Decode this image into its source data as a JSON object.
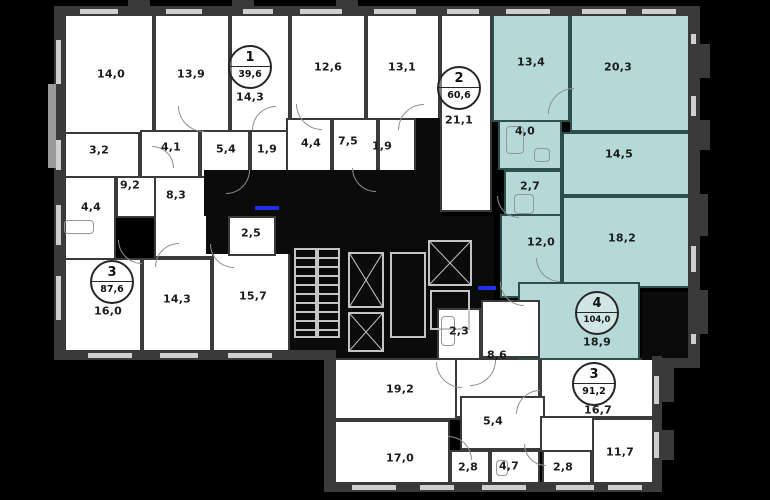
{
  "title": "apartment-floor-plan",
  "colors": {
    "background": "#000000",
    "wall": "#3a3a3a",
    "room_fill": "#ffffff",
    "selected_apartment_fill": "#b5d9d8",
    "selected_apartment_wall": "#2e4d4d",
    "window": "#cfcfcf",
    "core_lines": "#c4c4c4",
    "entry_marker": "#2330e8",
    "label_text": "#1b1b1b"
  },
  "apartments": [
    {
      "number": "1",
      "total_area": "39,6",
      "highlighted": false
    },
    {
      "number": "2",
      "total_area": "60,6",
      "highlighted": false
    },
    {
      "number": "3",
      "total_area": "87,6",
      "highlighted": false
    },
    {
      "number": "4",
      "total_area": "104,0",
      "highlighted": true
    },
    {
      "number": "3",
      "total_area": "91,2",
      "highlighted": false
    }
  ],
  "plan": {
    "width": 770,
    "height": 500,
    "rooms": [
      {
        "n": "room-14-0",
        "t": "room",
        "r": [
          62,
          14,
          92,
          120
        ]
      },
      {
        "n": "room-13-9",
        "t": "room",
        "r": [
          154,
          14,
          76,
          120
        ]
      },
      {
        "n": "apt1-room-14-3",
        "t": "room",
        "r": [
          230,
          14,
          60,
          120
        ]
      },
      {
        "n": "room-12-6",
        "t": "room",
        "r": [
          290,
          14,
          76,
          120
        ]
      },
      {
        "n": "room-13-1",
        "t": "room",
        "r": [
          366,
          14,
          74,
          120
        ]
      },
      {
        "n": "apt2-room-21-1",
        "t": "room",
        "r": [
          440,
          14,
          52,
          198
        ]
      },
      {
        "n": "room-3-2",
        "t": "room",
        "r": [
          62,
          132,
          78,
          46
        ]
      },
      {
        "n": "room-4-1",
        "t": "room",
        "r": [
          140,
          130,
          60,
          48
        ]
      },
      {
        "n": "room-5-4",
        "t": "room",
        "r": [
          200,
          130,
          50,
          48
        ]
      },
      {
        "n": "room-1-9",
        "t": "room",
        "r": [
          250,
          130,
          38,
          48
        ]
      },
      {
        "n": "room-4-4-left",
        "t": "room",
        "r": [
          62,
          176,
          54,
          84
        ]
      },
      {
        "n": "hall-9-2",
        "t": "room",
        "r": [
          116,
          176,
          88,
          42
        ]
      },
      {
        "n": "hall-8-3",
        "t": "room",
        "r": [
          154,
          176,
          62,
          82
        ]
      },
      {
        "n": "room-16-0",
        "t": "room",
        "r": [
          62,
          258,
          80,
          96
        ]
      },
      {
        "n": "room-14-3-b",
        "t": "room",
        "r": [
          142,
          258,
          70,
          96
        ]
      },
      {
        "n": "room-15-7",
        "t": "room",
        "r": [
          212,
          250,
          78,
          104
        ]
      },
      {
        "n": "room-4-4-top",
        "t": "room",
        "r": [
          286,
          118,
          46,
          54
        ]
      },
      {
        "n": "room-7-5",
        "t": "room",
        "r": [
          332,
          118,
          46,
          54
        ]
      },
      {
        "n": "room-1-9-top",
        "t": "room",
        "r": [
          378,
          118,
          38,
          54
        ]
      },
      {
        "n": "room-19-2",
        "t": "room",
        "r": [
          332,
          358,
          128,
          62
        ]
      },
      {
        "n": "hall-8-6-lower",
        "t": "room",
        "r": [
          455,
          358,
          85,
          60
        ]
      },
      {
        "n": "apt3b-room-16-7",
        "t": "room",
        "r": [
          540,
          358,
          114,
          60
        ]
      },
      {
        "n": "hall-5-4-b",
        "t": "room",
        "r": [
          460,
          396,
          85,
          54
        ]
      },
      {
        "n": "hall-sliver",
        "t": "room",
        "r": [
          540,
          416,
          54,
          36
        ]
      },
      {
        "n": "room-17-0",
        "t": "room",
        "r": [
          332,
          420,
          118,
          64
        ]
      },
      {
        "n": "room-2-8-a",
        "t": "room",
        "r": [
          450,
          450,
          40,
          34
        ]
      },
      {
        "n": "room-4-7",
        "t": "room",
        "r": [
          490,
          450,
          50,
          34
        ]
      },
      {
        "n": "room-2-8-b",
        "t": "room",
        "r": [
          542,
          450,
          50,
          34
        ]
      },
      {
        "n": "room-11-7",
        "t": "room",
        "r": [
          592,
          418,
          62,
          66
        ]
      },
      {
        "n": "apt4-room-13-4",
        "t": "teal",
        "r": [
          492,
          14,
          78,
          108
        ]
      },
      {
        "n": "apt4-room-20-3",
        "t": "teal",
        "r": [
          570,
          14,
          120,
          118
        ]
      },
      {
        "n": "apt4-bath-4-0",
        "t": "teal",
        "r": [
          498,
          120,
          64,
          50
        ]
      },
      {
        "n": "apt4-room-14-5",
        "t": "teal",
        "r": [
          562,
          132,
          128,
          64
        ]
      },
      {
        "n": "apt4-bath-2-7",
        "t": "teal",
        "r": [
          504,
          170,
          58,
          46
        ]
      },
      {
        "n": "apt4-hall-12-0",
        "t": "teal",
        "r": [
          500,
          214,
          62,
          84
        ]
      },
      {
        "n": "apt4-room-18-2",
        "t": "teal",
        "r": [
          562,
          196,
          128,
          92
        ]
      },
      {
        "n": "apt4-room-18-9",
        "t": "teal",
        "r": [
          518,
          282,
          122,
          78
        ]
      }
    ],
    "dark": [
      {
        "n": "public-corridor",
        "r": [
          204,
          170,
          236,
          46
        ]
      },
      {
        "n": "core-block",
        "r": [
          290,
          216,
          204,
          142
        ]
      },
      {
        "n": "shaft-strip",
        "r": [
          416,
          118,
          24,
          98
        ]
      },
      {
        "n": "void-right",
        "r": [
          642,
          292,
          48,
          68
        ]
      },
      {
        "n": "corridor-niche-a",
        "r": [
          206,
          216,
          26,
          38
        ]
      },
      {
        "n": "corridor-niche-b",
        "r": [
          276,
          216,
          14,
          38
        ]
      }
    ],
    "punch": [
      {
        "n": "room-2-5",
        "r": [
          228,
          216,
          48,
          40
        ]
      },
      {
        "n": "room-2-3",
        "r": [
          437,
          308,
          44,
          52
        ]
      },
      {
        "n": "hall-8-6-upper",
        "r": [
          481,
          300,
          59,
          58
        ]
      }
    ],
    "stairs": [
      {
        "n": "stair-flight-a",
        "r": [
          294,
          248,
          23,
          90
        ]
      },
      {
        "n": "stair-flight-b",
        "r": [
          317,
          248,
          23,
          90
        ]
      }
    ],
    "elevators": [
      {
        "n": "elevator-a",
        "r": [
          348,
          252,
          36,
          56
        ]
      },
      {
        "n": "elevator-b",
        "r": [
          348,
          312,
          36,
          40
        ]
      },
      {
        "n": "elevator-c",
        "r": [
          428,
          240,
          44,
          46
        ]
      }
    ],
    "coreboxes": [
      {
        "n": "shaft-box",
        "r": [
          390,
          252,
          36,
          86
        ]
      },
      {
        "n": "lobby-box",
        "r": [
          430,
          290,
          40,
          40
        ]
      }
    ],
    "walls": [
      {
        "r": [
          54,
          6,
          646,
          10
        ]
      },
      {
        "r": [
          54,
          6,
          12,
          354
        ]
      },
      {
        "r": [
          54,
          350,
          280,
          10
        ]
      },
      {
        "r": [
          324,
          350,
          12,
          142
        ]
      },
      {
        "r": [
          324,
          482,
          338,
          10
        ]
      },
      {
        "r": [
          652,
          356,
          10,
          136
        ]
      },
      {
        "r": [
          688,
          6,
          12,
          362
        ]
      },
      {
        "r": [
          652,
          358,
          48,
          10
        ]
      }
    ],
    "windows": [
      {
        "r": [
          80,
          9,
          38,
          5
        ]
      },
      {
        "r": [
          166,
          9,
          36,
          5
        ]
      },
      {
        "r": [
          243,
          9,
          30,
          5
        ]
      },
      {
        "r": [
          300,
          9,
          42,
          5
        ]
      },
      {
        "r": [
          374,
          9,
          42,
          5
        ]
      },
      {
        "r": [
          447,
          9,
          32,
          5
        ]
      },
      {
        "r": [
          506,
          9,
          44,
          5
        ]
      },
      {
        "r": [
          582,
          9,
          44,
          5
        ]
      },
      {
        "r": [
          642,
          9,
          34,
          5
        ]
      },
      {
        "r": [
          56,
          40,
          5,
          44
        ]
      },
      {
        "r": [
          56,
          140,
          5,
          30
        ]
      },
      {
        "r": [
          56,
          205,
          5,
          40
        ]
      },
      {
        "r": [
          56,
          276,
          5,
          44
        ]
      },
      {
        "r": [
          88,
          353,
          44,
          5
        ]
      },
      {
        "r": [
          160,
          353,
          38,
          5
        ]
      },
      {
        "r": [
          228,
          353,
          44,
          5
        ]
      },
      {
        "r": [
          352,
          485,
          44,
          5
        ]
      },
      {
        "r": [
          420,
          485,
          34,
          5
        ]
      },
      {
        "r": [
          482,
          485,
          44,
          5
        ]
      },
      {
        "r": [
          556,
          485,
          38,
          5
        ]
      },
      {
        "r": [
          608,
          485,
          34,
          5
        ]
      },
      {
        "r": [
          691,
          34,
          5,
          36
        ]
      },
      {
        "r": [
          691,
          96,
          5,
          20
        ]
      },
      {
        "r": [
          691,
          246,
          5,
          26
        ]
      },
      {
        "r": [
          691,
          316,
          5,
          28
        ]
      },
      {
        "r": [
          654,
          376,
          5,
          28
        ]
      },
      {
        "r": [
          654,
          432,
          5,
          26
        ]
      }
    ],
    "stubs": [
      {
        "r": [
          688,
          44,
          22,
          34
        ]
      },
      {
        "r": [
          690,
          120,
          20,
          30
        ]
      },
      {
        "r": [
          690,
          194,
          18,
          42
        ]
      },
      {
        "r": [
          690,
          290,
          18,
          44
        ]
      },
      {
        "r": [
          662,
          366,
          12,
          36
        ]
      },
      {
        "r": [
          662,
          430,
          12,
          30
        ]
      },
      {
        "r": [
          128,
          0,
          22,
          8
        ]
      },
      {
        "r": [
          232,
          0,
          22,
          8
        ]
      },
      {
        "r": [
          336,
          0,
          22,
          8
        ]
      }
    ],
    "grays": [
      {
        "r": [
          48,
          84,
          8,
          84
        ]
      }
    ],
    "blues": [
      {
        "r": [
          255,
          206,
          24,
          4
        ]
      },
      {
        "r": [
          478,
          286,
          18,
          4
        ]
      }
    ],
    "fixtures": [
      {
        "n": "bathtub-icon",
        "r": [
          64,
          220,
          30,
          14
        ]
      },
      {
        "n": "bathtub-icon",
        "r": [
          506,
          126,
          18,
          28
        ]
      },
      {
        "n": "washer-icon",
        "r": [
          534,
          148,
          16,
          14
        ]
      },
      {
        "n": "shower-icon",
        "r": [
          514,
          194,
          20,
          20
        ]
      },
      {
        "n": "bathtub-icon",
        "r": [
          441,
          316,
          14,
          30
        ]
      },
      {
        "n": "toilet-icon",
        "r": [
          496,
          460,
          12,
          16
        ]
      }
    ],
    "doors": [
      {
        "r": [
          178,
          106,
          26,
          26
        ],
        "rot": 0
      },
      {
        "r": [
          252,
          106,
          24,
          24
        ],
        "rot": 90
      },
      {
        "r": [
          296,
          104,
          26,
          26
        ],
        "rot": 0
      },
      {
        "r": [
          398,
          104,
          26,
          26
        ],
        "rot": 90
      },
      {
        "r": [
          152,
          146,
          22,
          22
        ],
        "rot": 180
      },
      {
        "r": [
          226,
          170,
          24,
          24
        ],
        "rot": 270
      },
      {
        "r": [
          352,
          168,
          24,
          24
        ],
        "rot": 0
      },
      {
        "r": [
          548,
          88,
          26,
          26
        ],
        "rot": 90
      },
      {
        "r": [
          497,
          196,
          22,
          22
        ],
        "rot": 0
      },
      {
        "r": [
          536,
          258,
          24,
          24
        ],
        "rot": 0
      },
      {
        "r": [
          118,
          240,
          24,
          24
        ],
        "rot": 0
      },
      {
        "r": [
          155,
          243,
          24,
          24
        ],
        "rot": 90
      },
      {
        "r": [
          210,
          244,
          24,
          24
        ],
        "rot": 0
      },
      {
        "r": [
          470,
          360,
          26,
          26
        ],
        "rot": 270
      },
      {
        "r": [
          500,
          282,
          24,
          24
        ],
        "rot": 0
      },
      {
        "r": [
          516,
          390,
          24,
          24
        ],
        "rot": 90
      },
      {
        "r": [
          436,
          362,
          26,
          26
        ],
        "rot": 0
      },
      {
        "r": [
          448,
          436,
          24,
          24
        ],
        "rot": 180
      },
      {
        "r": [
          524,
          444,
          22,
          22
        ],
        "rot": 0
      }
    ],
    "labels": [
      {
        "text": "14,0",
        "x": 111,
        "y": 74
      },
      {
        "text": "13,9",
        "x": 191,
        "y": 74
      },
      {
        "text": "14,3",
        "x": 250,
        "y": 97
      },
      {
        "text": "12,6",
        "x": 328,
        "y": 67
      },
      {
        "text": "13,1",
        "x": 402,
        "y": 67
      },
      {
        "text": "21,1",
        "x": 459,
        "y": 120
      },
      {
        "text": "13,4",
        "x": 531,
        "y": 62
      },
      {
        "text": "20,3",
        "x": 618,
        "y": 67
      },
      {
        "text": "3,2",
        "x": 99,
        "y": 150
      },
      {
        "text": "4,1",
        "x": 171,
        "y": 147
      },
      {
        "text": "5,4",
        "x": 226,
        "y": 149
      },
      {
        "text": "1,9",
        "x": 267,
        "y": 149
      },
      {
        "text": "9,2",
        "x": 130,
        "y": 185
      },
      {
        "text": "4,4",
        "x": 91,
        "y": 207
      },
      {
        "text": "8,3",
        "x": 176,
        "y": 195
      },
      {
        "text": "2,5",
        "x": 251,
        "y": 233
      },
      {
        "text": "4,4",
        "x": 311,
        "y": 143
      },
      {
        "text": "7,5",
        "x": 348,
        "y": 141
      },
      {
        "text": "1,9",
        "x": 382,
        "y": 146
      },
      {
        "text": "4,0",
        "x": 525,
        "y": 131
      },
      {
        "text": "14,5",
        "x": 619,
        "y": 154
      },
      {
        "text": "2,7",
        "x": 530,
        "y": 186
      },
      {
        "text": "12,0",
        "x": 541,
        "y": 242
      },
      {
        "text": "18,2",
        "x": 622,
        "y": 238
      },
      {
        "text": "18,9",
        "x": 597,
        "y": 342
      },
      {
        "text": "16,0",
        "x": 108,
        "y": 311
      },
      {
        "text": "14,3",
        "x": 177,
        "y": 299
      },
      {
        "text": "15,7",
        "x": 253,
        "y": 296
      },
      {
        "text": "19,2",
        "x": 400,
        "y": 389
      },
      {
        "text": "2,3",
        "x": 459,
        "y": 331
      },
      {
        "text": "8,6",
        "x": 497,
        "y": 355
      },
      {
        "text": "5,4",
        "x": 493,
        "y": 421
      },
      {
        "text": "16,7",
        "x": 598,
        "y": 410
      },
      {
        "text": "17,0",
        "x": 400,
        "y": 458
      },
      {
        "text": "2,8",
        "x": 468,
        "y": 467
      },
      {
        "text": "4,7",
        "x": 509,
        "y": 466
      },
      {
        "text": "2,8",
        "x": 563,
        "y": 467
      },
      {
        "text": "11,7",
        "x": 620,
        "y": 452
      }
    ],
    "badges": [
      {
        "number": "1",
        "area": "39,6",
        "x": 250,
        "y": 67
      },
      {
        "number": "2",
        "area": "60,6",
        "x": 459,
        "y": 88
      },
      {
        "number": "3",
        "area": "87,6",
        "x": 112,
        "y": 282
      },
      {
        "number": "4",
        "area": "104,0",
        "x": 597,
        "y": 313
      },
      {
        "number": "3",
        "area": "91,2",
        "x": 594,
        "y": 384
      }
    ]
  }
}
